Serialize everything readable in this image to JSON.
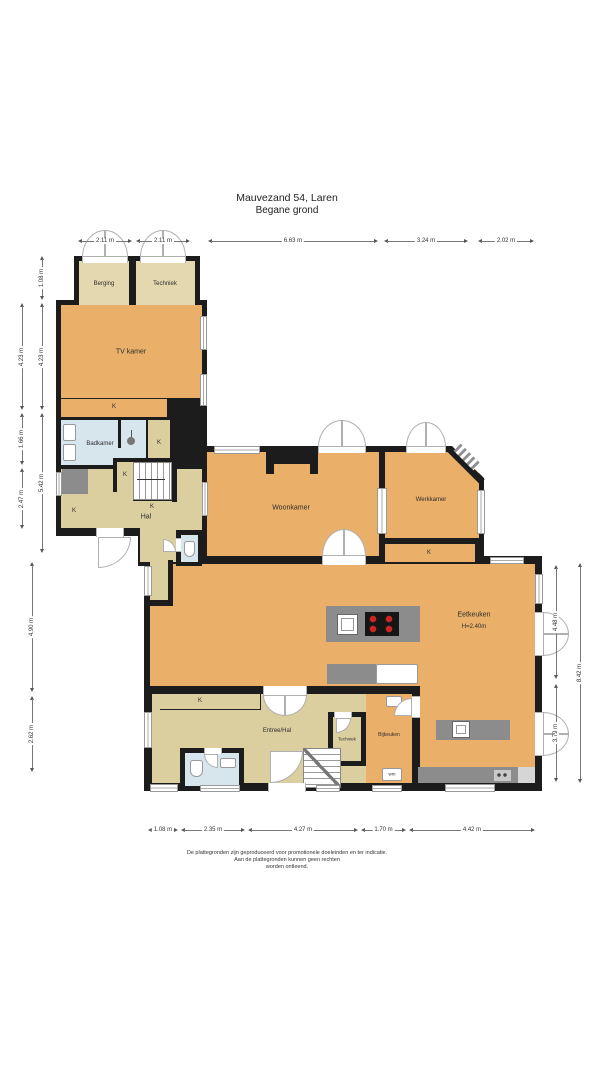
{
  "title": {
    "address": "Mauvezand 54, Laren",
    "floor": "Begane grond"
  },
  "rooms": {
    "berging": {
      "label": "Berging"
    },
    "techniek_top": {
      "label": "Techniek"
    },
    "tv_kamer": {
      "label": "TV kamer"
    },
    "badkamer": {
      "label": "Badkamer"
    },
    "hal": {
      "label": "Hal"
    },
    "woonkamer": {
      "label": "Woonkamer"
    },
    "werkkamer": {
      "label": "Werkkamer"
    },
    "eetkeuken": {
      "label": "Eetkeuken",
      "height_note": "H=2.40m"
    },
    "entree": {
      "label": "Entree/Hal"
    },
    "techniek_bottom": {
      "label": "Techniek"
    },
    "bijkeuken": {
      "label": "Bijkeuken"
    }
  },
  "labels": {
    "closet": "K",
    "washer": "wm"
  },
  "dimensions": [
    {
      "text": "2.11 m",
      "orient": "h",
      "x": 78,
      "y": 237,
      "len": 54
    },
    {
      "text": "2.11 m",
      "orient": "h",
      "x": 136,
      "y": 237,
      "len": 54
    },
    {
      "text": "6.63 m",
      "orient": "h",
      "x": 208,
      "y": 237,
      "len": 170
    },
    {
      "text": "3.24 m",
      "orient": "h",
      "x": 384,
      "y": 237,
      "len": 84
    },
    {
      "text": "2.02 m",
      "orient": "h",
      "x": 478,
      "y": 237,
      "len": 56
    },
    {
      "text": "1.08 m",
      "orient": "h",
      "x": 148,
      "y": 826,
      "len": 30
    },
    {
      "text": "2.35 m",
      "orient": "h",
      "x": 181,
      "y": 826,
      "len": 64
    },
    {
      "text": "4.27 m",
      "orient": "h",
      "x": 248,
      "y": 826,
      "len": 110
    },
    {
      "text": "1.70 m",
      "orient": "h",
      "x": 361,
      "y": 826,
      "len": 45
    },
    {
      "text": "4.42 m",
      "orient": "h",
      "x": 409,
      "y": 826,
      "len": 126
    },
    {
      "text": "4.23 m",
      "orient": "v",
      "x": 18,
      "y": 303,
      "len": 107
    },
    {
      "text": "1.66 m",
      "orient": "v",
      "x": 18,
      "y": 413,
      "len": 52
    },
    {
      "text": "2.47 m",
      "orient": "v",
      "x": 18,
      "y": 468,
      "len": 61
    },
    {
      "text": "1.08 m",
      "orient": "v",
      "x": 38,
      "y": 256,
      "len": 44
    },
    {
      "text": "4.23 m",
      "orient": "v",
      "x": 38,
      "y": 303,
      "len": 107
    },
    {
      "text": "5.42 m",
      "orient": "v",
      "x": 38,
      "y": 413,
      "len": 140
    },
    {
      "text": "4.90 m",
      "orient": "v",
      "x": 28,
      "y": 562,
      "len": 130
    },
    {
      "text": "2.62 m",
      "orient": "v",
      "x": 28,
      "y": 696,
      "len": 76
    },
    {
      "text": "4.48 m",
      "orient": "v",
      "x": 552,
      "y": 565,
      "len": 114
    },
    {
      "text": "3.79 m",
      "orient": "v",
      "x": 552,
      "y": 684,
      "len": 98
    },
    {
      "text": "8.42 m",
      "orient": "v",
      "x": 576,
      "y": 563,
      "len": 220
    }
  ],
  "footer": {
    "line1": "De plattegronden zijn geproduceerd voor promotionele doeleinden en ter indicatie.",
    "line2": "Aan de plattegronden kunnen geen rechten",
    "line3": "worden ontleend."
  },
  "colors": {
    "wall": "#1c1c1c",
    "room_orange": "#eaaf68",
    "room_tan": "#dbcfa0",
    "annex_tan": "#e4d8ae",
    "bathroom_blue": "#d7e5ec",
    "counter_gray": "#8c8c8c",
    "burner_red": "#cf2424"
  }
}
